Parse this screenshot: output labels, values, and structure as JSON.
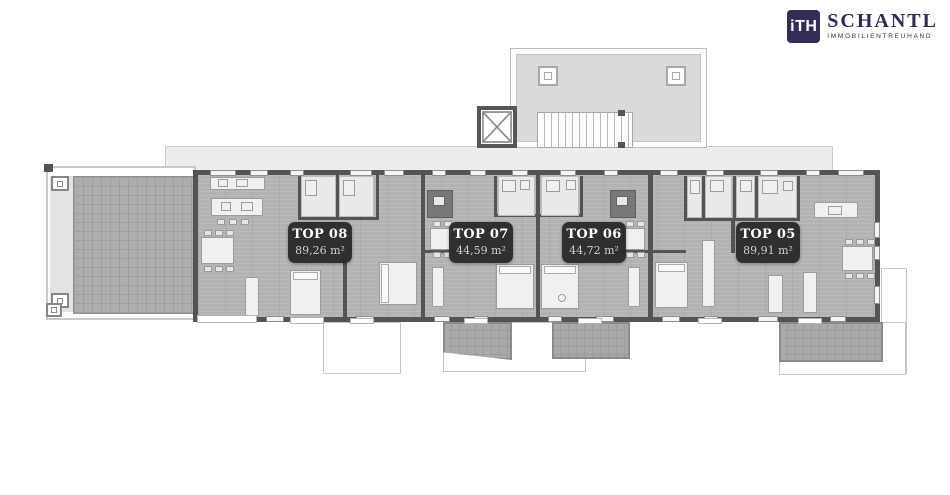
{
  "logo": {
    "mark": "iTH",
    "company": "SCHANTL",
    "tagline": "IMMOBILIENTREUHAND",
    "brand_color": "#312e57"
  },
  "floorplan": {
    "units": [
      {
        "id": "top-08",
        "label": "TOP 08",
        "area": "89,26 m²"
      },
      {
        "id": "top-07",
        "label": "TOP 07",
        "area": "44,59 m²"
      },
      {
        "id": "top-06",
        "label": "TOP 06",
        "area": "44,72 m²"
      },
      {
        "id": "top-05",
        "label": "TOP 05",
        "area": "89,91 m²"
      }
    ],
    "icons": [
      "elevator-x-icon",
      "staircase-icon",
      "skylight-icon"
    ],
    "colors": {
      "walls": "#545454",
      "floor": "#b3b3b3",
      "terrace": "#a9a9a9",
      "roof": "#dadada",
      "badge": "#2b2b2b",
      "badge_text": "#ffffff"
    }
  }
}
